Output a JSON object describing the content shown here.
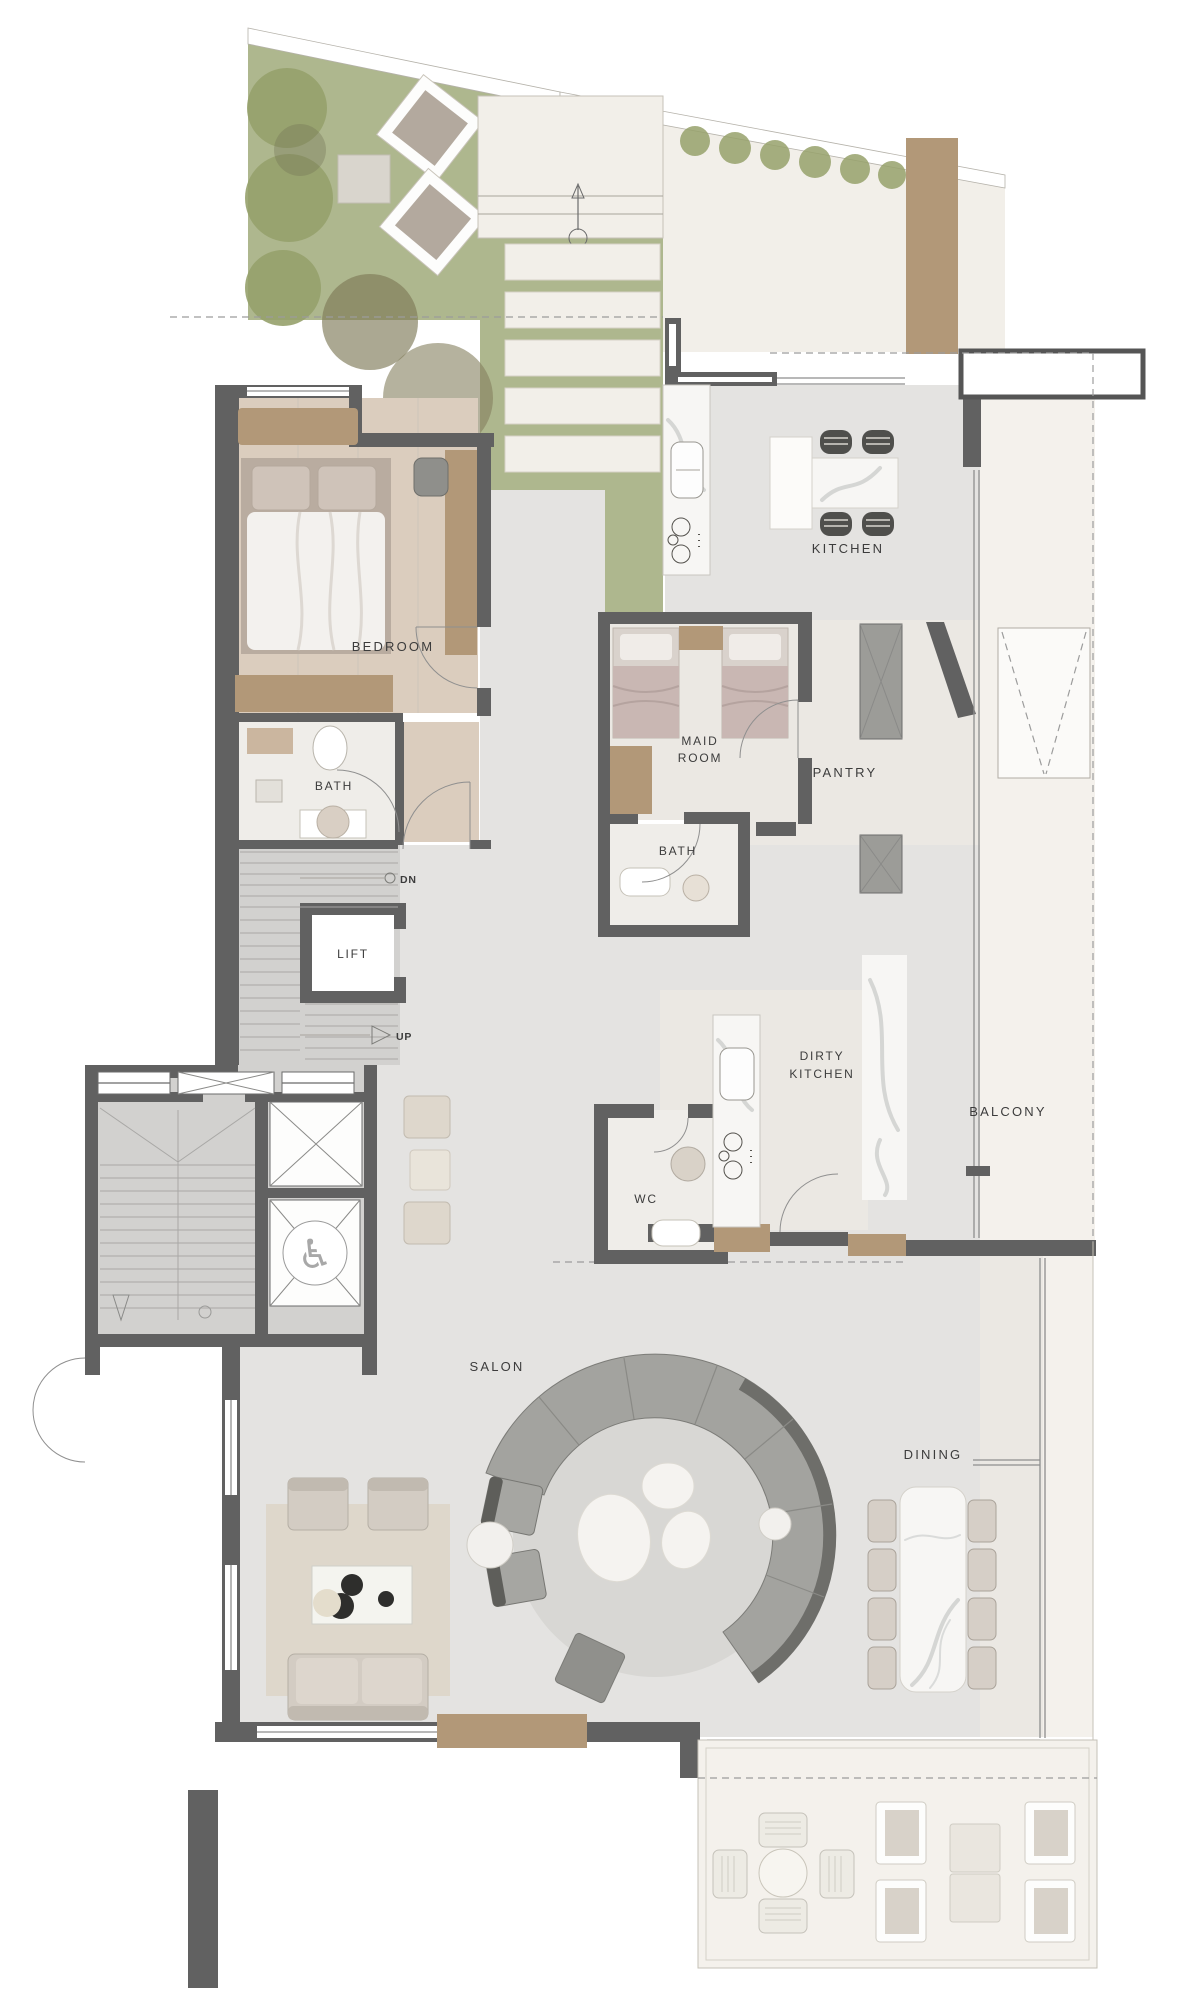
{
  "plan": {
    "labels": {
      "kitchen": "KITCHEN",
      "bedroom": "BEDROOM",
      "bedroom_bath": "BATH",
      "maid_line1": "MAID",
      "maid_line2": "ROOM",
      "maid_bath": "BATH",
      "pantry": "PANTRY",
      "lift": "LIFT",
      "dirty_line1": "DIRTY",
      "dirty_line2": "KITCHEN",
      "wc": "WC",
      "balcony": "BALCONY",
      "salon": "SALON",
      "dining": "DINING"
    },
    "markers": {
      "down": "DN",
      "up": "UP",
      "wheelchair_icon": "♿"
    },
    "palette": {
      "wall": "#616161",
      "white": "#ffffff",
      "floor": "#e4e3e1",
      "floorWarm": "#ebe8e3",
      "stairFloor": "#d2d1cf",
      "terrace": "#f2efe9",
      "cream": "#f4f1ec",
      "garden": "#aeb78e",
      "foliage": "#96a16b",
      "olive": "#8f8a66",
      "wood": "#b29878",
      "woodLight": "#cbb69f",
      "bedFloor": "#dbcdbe",
      "tile": "#efede9",
      "marble": "#f7f6f4",
      "rug": "#d8d7d4",
      "rugBeige": "#ddd5c9",
      "beigeFurn": "#d5cec5",
      "beigeLight": "#e9e4da",
      "sofa": "#a3a39f",
      "sofaDark": "#6e6e6a",
      "label": "#3c3c3c",
      "line": "#9c9c9c",
      "glass": "#8e8e8e"
    }
  }
}
